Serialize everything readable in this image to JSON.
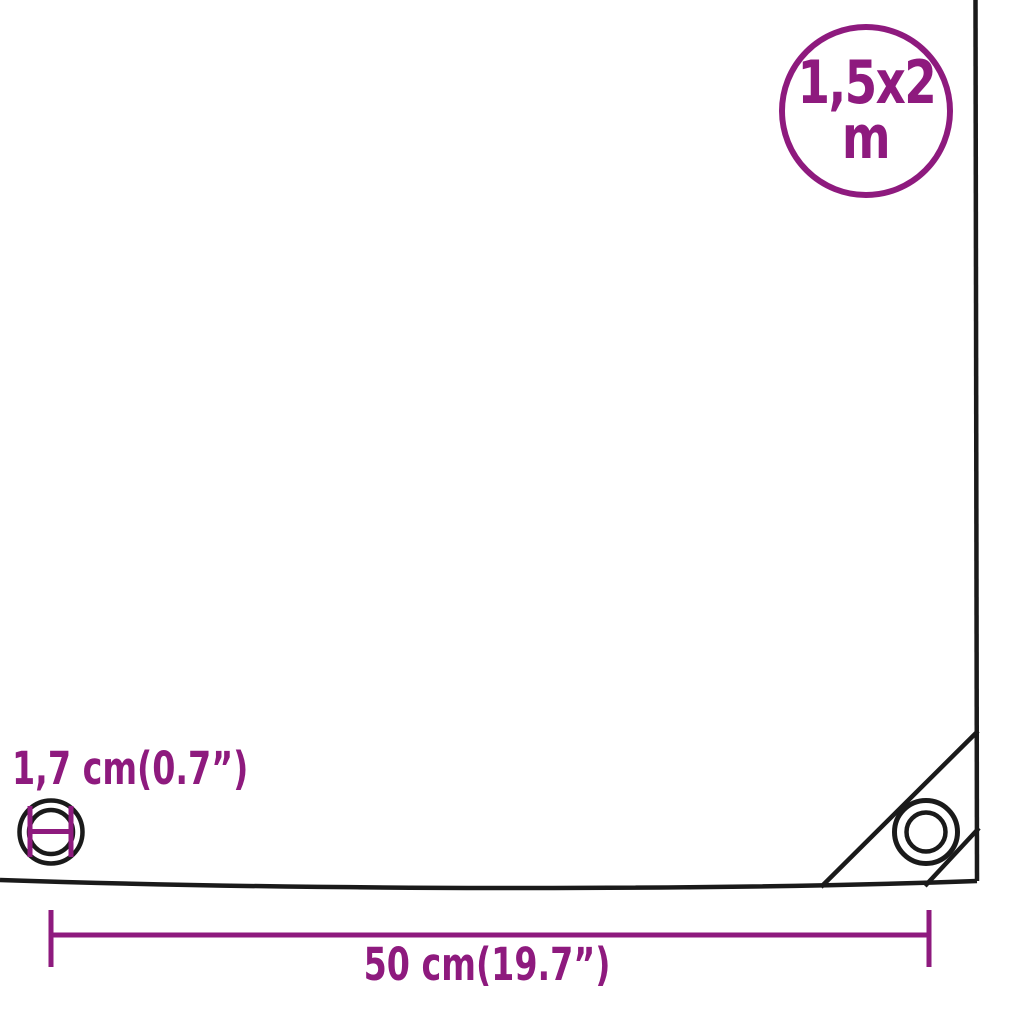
{
  "colors": {
    "accent_purple": "#8E1A7E",
    "line_black": "#1A1A1A",
    "background": "#FFFFFF"
  },
  "size_badge": {
    "value": "1,5x2",
    "unit": "m"
  },
  "eyelet": {
    "diameter_label": "1,7 cm(0.7”)"
  },
  "dimension": {
    "label": "50 cm(19.7”)"
  }
}
